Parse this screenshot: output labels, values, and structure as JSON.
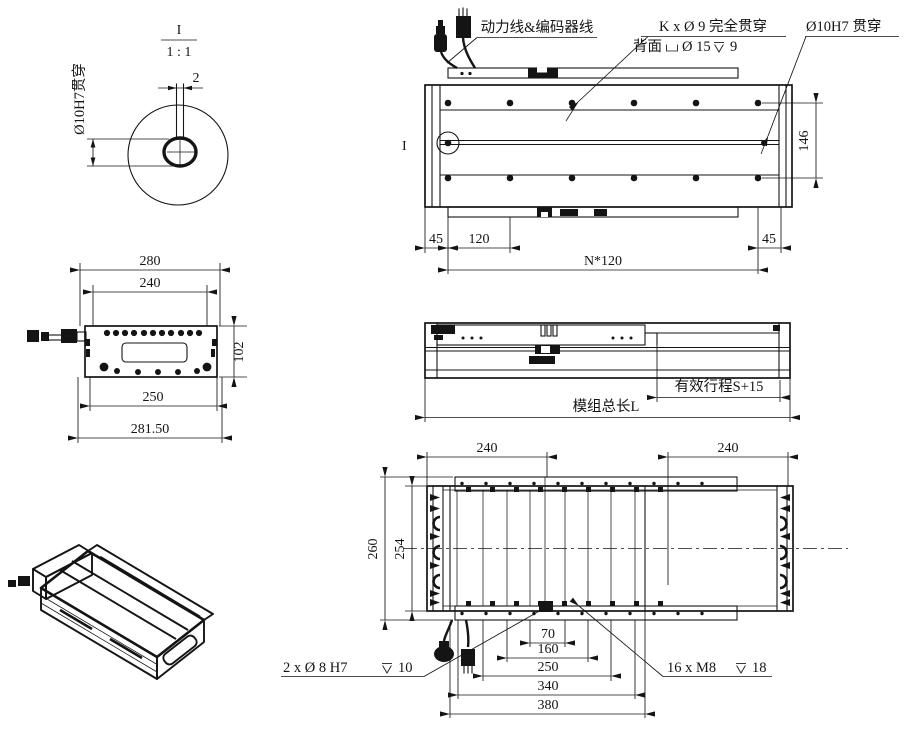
{
  "detail_view": {
    "marker": "I",
    "scale": "1 : 1",
    "slot_width": "2",
    "hole_label": "Ø10H7贯穿"
  },
  "top_view": {
    "cable_label": "动力线&编码器线",
    "hole_callout": {
      "line1": "K x Ø 9 完全贯穿",
      "back_prefix": "背面",
      "cb_dia": "Ø 15",
      "cb_depth": "9"
    },
    "pin_callout": "Ø10H7 贯穿",
    "detail_marker": "I",
    "dims": {
      "left_margin": "45",
      "pitch": "120",
      "total_pitch": "N*120",
      "right_margin": "45",
      "width": "146"
    }
  },
  "front_view": {
    "dims": {
      "top_width": "280",
      "inner_width": "240",
      "bottom_inner": "250",
      "overall": "281.50",
      "height": "102"
    }
  },
  "side_view": {
    "stroke": "有效行程S+15",
    "total_length": "模组总长L"
  },
  "bottom_view": {
    "dims": {
      "left_240": "240",
      "right_240": "240",
      "height_outer": "260",
      "height_inner": "254",
      "d70": "70",
      "d160": "160",
      "d250": "250",
      "d340": "340",
      "d380": "380"
    },
    "dowel_callout": {
      "text": "2 x Ø 8 H7",
      "depth": "10"
    },
    "screw_callout": {
      "text": "16 x  M8",
      "depth": "18"
    }
  },
  "symbols": {
    "counterbore": "counterbore-icon",
    "depth": "depth-icon"
  }
}
